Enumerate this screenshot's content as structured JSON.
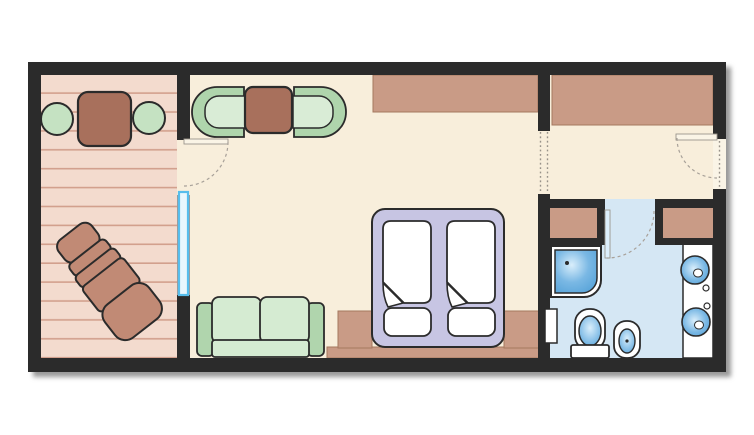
{
  "meta": {
    "type": "floor-plan",
    "rooms": [
      "balcony",
      "bedroom-living-room",
      "entry-hall",
      "bathroom"
    ]
  },
  "colors": {
    "background": "#ffffff",
    "wall": "#2b2b2b",
    "outline": "#2b2b2b",
    "floor_room": "#f8eedb",
    "floor_balcony": "#f3dbce",
    "balcony_stripe": "#d2a08d",
    "floor_bath": "#d5e7f4",
    "cabinet_tan": "#c99b86",
    "cabinet_edge": "#a5785f",
    "table_brown": "#a8705c",
    "lounger_brown": "#c18a75",
    "chair_green": "#c5e2c2",
    "chair_rim_green": "#afd5ac",
    "chair_seat_green": "#d9ecd6",
    "sofa_arm_green": "#b0d5ad",
    "sofa_seat_green": "#d5ebd2",
    "bed_frame_lavender": "#c7c5e3",
    "fixture_white": "#ffffff",
    "water_blue_dark": "#4a9bd4",
    "water_blue_mid": "#7ab8e4",
    "water_blue_light": "#d9eefb",
    "window_frame_blue": "#56bdec",
    "window_glass_blue": "#e8f7fe",
    "door_leaf": "#faf4e6",
    "door_leaf_bath": "#dceefb",
    "door_edge": "#9b958c",
    "swing_arc": "#a8a199",
    "threshold_dots": "#98928a"
  },
  "scene": {
    "balcony_furniture": [
      "patio-table",
      "patio-chair",
      "patio-chair",
      "sun-lounger"
    ],
    "bedroom_furniture": [
      "armchair",
      "coffee-table",
      "armchair",
      "wardrobe",
      "sofa",
      "double-bed",
      "pillow",
      "pillow",
      "nightstand",
      "nightstand",
      "headboard-ledge"
    ],
    "entry_hall_furniture": [
      "closet"
    ],
    "bathroom_fixtures": [
      "cabinet",
      "cabinet",
      "shower",
      "toilet",
      "bidet",
      "vanity-counter",
      "washbasin",
      "washbasin",
      "wall-niche"
    ],
    "openings": [
      "balcony-door",
      "balcony-window",
      "interior-passage",
      "bathroom-door",
      "entry-door"
    ]
  }
}
